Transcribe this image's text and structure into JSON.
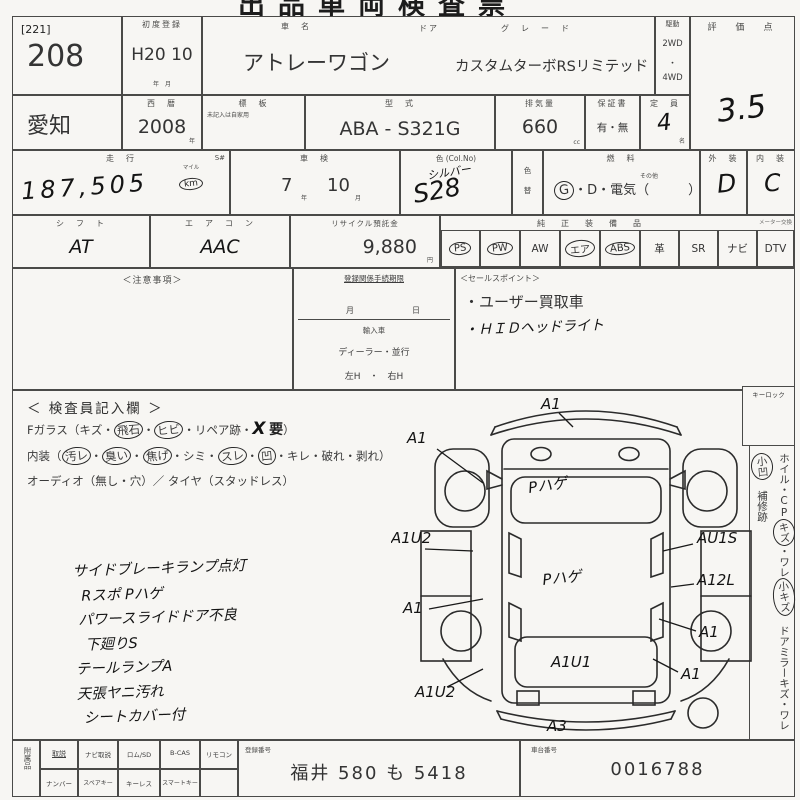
{
  "title": {
    "cropped": "出品車両検査票"
  },
  "r1": {
    "bracket": "[221]",
    "lot": "208",
    "first_reg_label": "初度登録",
    "first_reg": "H20 10",
    "first_reg_units": "年　月",
    "name_label": "車　名",
    "name": "アトレーワゴン",
    "door_label": "ドア",
    "grade_label": "グ　レ　ー　ド",
    "grade": "カスタムターボRSリミテッド",
    "drive_label": "駆動",
    "drive_1": "2WD",
    "drive_sep": "・",
    "drive_2": "4WD",
    "score_label": "評　価　点",
    "score": "3.5"
  },
  "r2": {
    "region": "愛知",
    "year_label": "西　暦",
    "year": "2008",
    "year_unit": "年",
    "plate_label": "標　板",
    "plate_note": "未記入は自家用",
    "model_label": "型　式",
    "model": "ABA - S321G",
    "disp_label": "排気量",
    "disp": "660",
    "disp_unit": "cc",
    "warranty_label": "保証書",
    "warranty": "有・無",
    "cap_label": "定　員",
    "cap": "4",
    "cap_unit": "名"
  },
  "r3": {
    "mileage_label": "走　行",
    "s_mark": "S#",
    "mileage": "187,505",
    "mile_unit_top": "マイル",
    "mile_unit": "km",
    "shaken_label": "車　検",
    "shaken_y": "7",
    "shaken_y_unit": "年",
    "shaken_m": "10",
    "shaken_m_unit": "月",
    "color_label": "色 (Col.No)",
    "color_name": "シルバー",
    "color_no": "S28",
    "color_chg_1": "色",
    "color_chg_2": "替",
    "fuel_label": "燃　料",
    "fuel_other": "その他",
    "fuel_g": "G",
    "fuel_rest": "・D・電気（　　　）",
    "ext_label": "外　装",
    "ext": "D",
    "int_label": "内　装",
    "int": "C"
  },
  "r4": {
    "shift_label": "シ　フ　ト",
    "shift": "AT",
    "ac_label": "エ　ア　コ　ン",
    "ac": "AAC",
    "recycle_label": "リサイクル預託金",
    "recycle": "9,880",
    "recycle_unit": "円",
    "equip_label": "純　正　装　備　品",
    "meter_note": "メーター交換",
    "eq": [
      "PS",
      "PW",
      "AW",
      "エア",
      "ABS",
      "革",
      "SR",
      "ナビ",
      "DTV"
    ]
  },
  "r5": {
    "notes_label": "＜注意事項＞",
    "reg_title": "登録関係手続期限",
    "reg_month": "月",
    "reg_day": "日",
    "reg_import": "輸入車",
    "reg_dealer": "ディーラー・並行",
    "reg_hand": "左H　・　右H",
    "sales_label": "＜セールスポイント＞",
    "sales_1": "・ユーザー買取車",
    "sales_2": "・ＨＩＤヘッドライト"
  },
  "insp": {
    "title": "＜ 検査員記入欄 ＞",
    "g0": "Fガラス（キズ・",
    "g1": "飛石",
    "g2": "・",
    "g3": "ヒビ",
    "g4": "・リペア跡・",
    "g5": "X",
    "g6": "要",
    "g7": "）",
    "i0": "内装（",
    "i1": "汚レ",
    "i2": "・",
    "i3": "臭い",
    "i4": "・",
    "i5": "焦げ",
    "i6": "・シミ・",
    "i7": "スレ",
    "i8": "・",
    "i9": "凹",
    "i10": "・キレ・破れ・剥れ）",
    "audio": "オーディオ（無し・穴）／ タイヤ（スタッドレス）",
    "notes": [
      "サイドブレーキランプ点灯",
      "Rスポ Pハゲ",
      "パワースライドドア不良",
      "下廻りS",
      "テールランプA",
      "天張ヤニ汚れ",
      "シートカバー付"
    ]
  },
  "diagram": {
    "top": "A1",
    "front_left": "A1",
    "hood": "Pハゲ",
    "left_mid": "A1U2",
    "right_mid": "AU1S",
    "roof": "Pハゲ",
    "right_qtr": "A12L",
    "left_rear": "A1",
    "right_rear": "A1",
    "tailgate": "A1U1",
    "right_low": "A1",
    "left_low": "A1U2",
    "rear_bumper": "A3"
  },
  "strip": {
    "keylock": "キーロック",
    "s0": "ホイル・CP",
    "s1": "キズ",
    "s2": "・ワレ",
    "s3": "小キズ",
    "s4": "　ドアミラーキズ・ワレ",
    "s5": "小凹",
    "s6": "　補修跡"
  },
  "bottom": {
    "acc_label": "附属品",
    "row1": [
      "取説",
      "ナビ取説",
      "ロム/SD",
      "B-CAS",
      "リモコン"
    ],
    "row2": [
      "ナンバー",
      "スペアキー",
      "キーレス",
      "スマートキー"
    ],
    "plate_label": "登録番号",
    "plate": "福井 580 も 5418",
    "chassis_label": "車台番号",
    "chassis": "0016788"
  }
}
